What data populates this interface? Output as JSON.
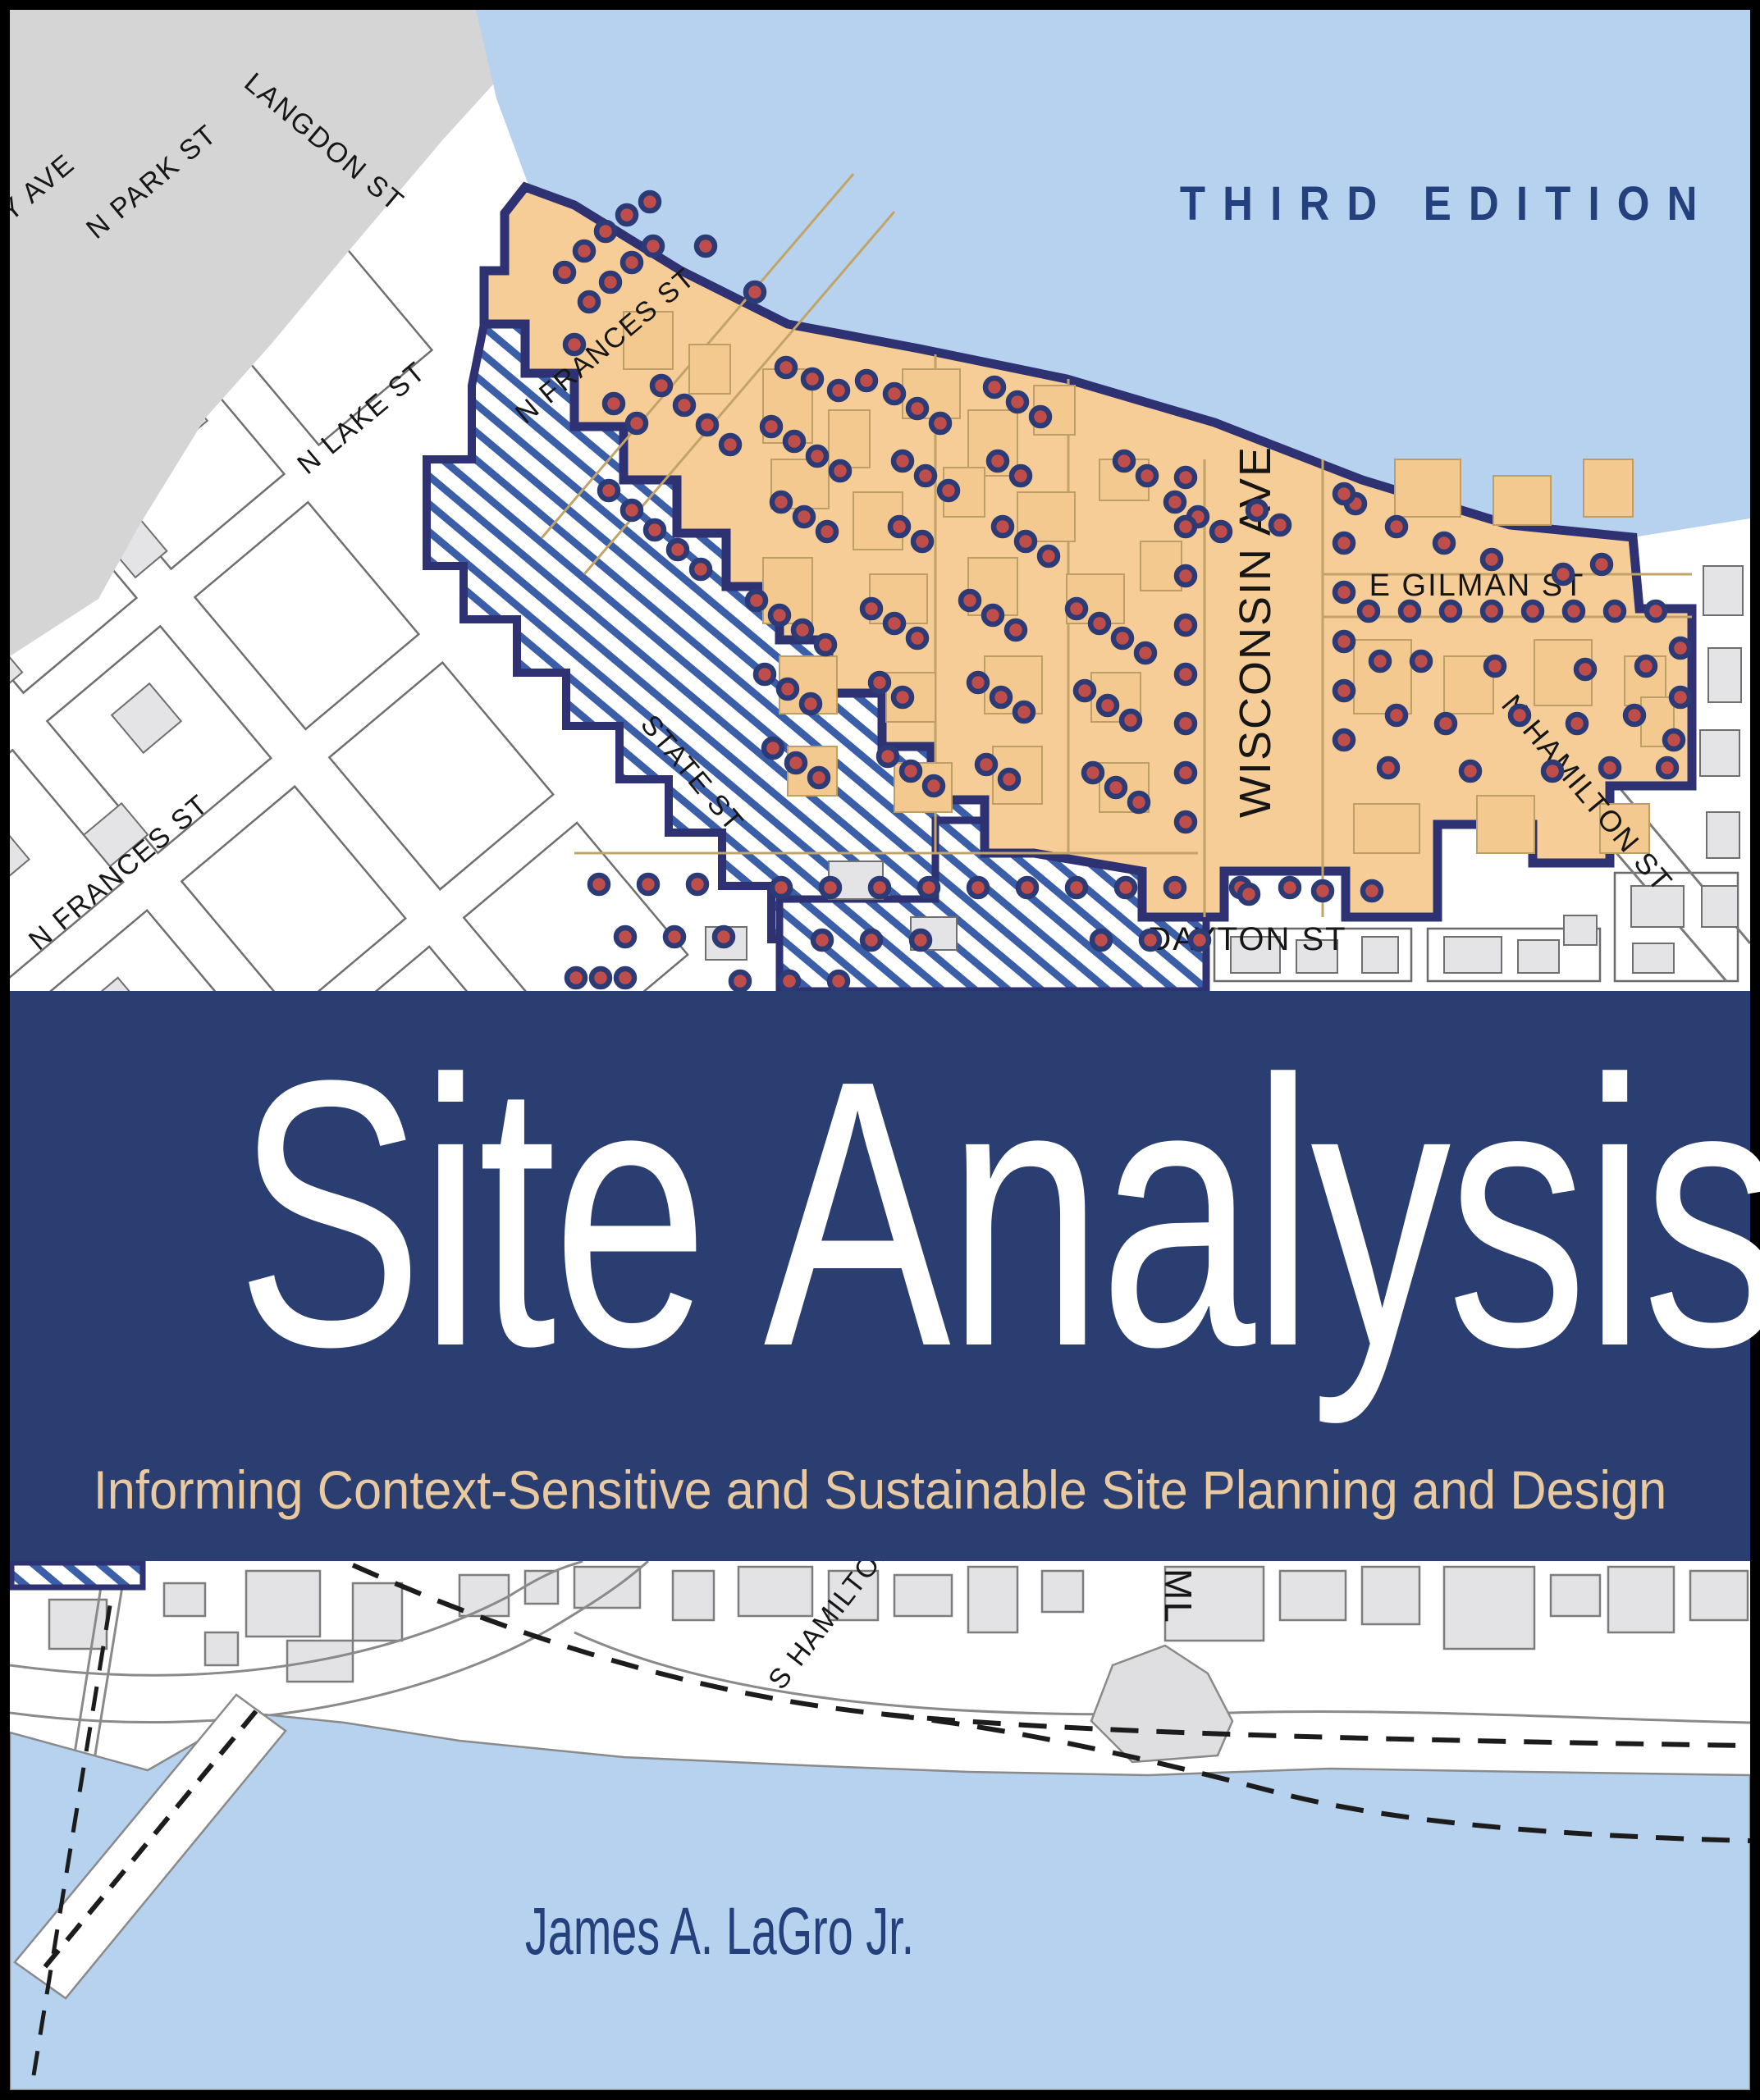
{
  "edition_label": "THIRD EDITION",
  "title": "Site Analysis",
  "subtitle": "Informing Context-Sensitive and Sustainable Site Planning and Design",
  "author": "James A. LaGro Jr.",
  "colors": {
    "frame": "#000000",
    "water": "#b7d2ee",
    "land": "#ffffff",
    "campus": "#d5d5d6",
    "building_fill": "#e4e4e6",
    "building_stroke": "#6f6f72",
    "district_fill": "#f6cd96",
    "district_building_fill": "#f3c98f",
    "district_building_stroke": "#bd9e66",
    "navy_border": "#2e3273",
    "hatch_blue": "#3b5ea9",
    "dot_red": "#bf4e4a",
    "dot_ring": "#2c3a75",
    "band_navy": "#2b3e71",
    "title_white": "#ffffff",
    "subtitle_tan": "#e9c9a0",
    "heading_navy": "#24407d",
    "street_label": "#161616"
  },
  "map_top": {
    "street_labels": {
      "university_ave": "ITY AVE",
      "n_park_st": "N PARK ST",
      "langdon_st": "LANGDON ST",
      "n_lake_st": "N LAKE ST",
      "n_frances_st_upper": "N FRANCES ST",
      "n_frances_st_lower": "N FRANCES ST",
      "wisconsin_ave": "WISCONSIN AVE",
      "e_gilman_st": "E GILMAN ST",
      "state_st": "STATE ST",
      "dayton_st": "DAYTON ST",
      "n_hamilton_st": "N HAMILTON ST"
    },
    "dot_radius": 11,
    "block_size": [
      180,
      210
    ],
    "blocks_diagonal": [
      [
        -700,
        -300
      ],
      [
        -700,
        -45
      ],
      [
        -700,
        210
      ],
      [
        -700,
        465
      ],
      [
        -700,
        720
      ],
      [
        -700,
        975
      ],
      [
        -700,
        1230
      ],
      [
        -465,
        -300
      ],
      [
        -465,
        -45
      ],
      [
        -465,
        210
      ],
      [
        -465,
        465
      ],
      [
        -465,
        720
      ],
      [
        -465,
        975
      ],
      [
        -465,
        1230
      ],
      [
        -230,
        -300
      ],
      [
        -230,
        -45
      ],
      [
        -230,
        210
      ],
      [
        -230,
        465
      ],
      [
        -230,
        720
      ],
      [
        -230,
        975
      ],
      [
        -230,
        1230
      ],
      [
        5,
        -300
      ],
      [
        5,
        -45
      ],
      [
        5,
        210
      ],
      [
        5,
        465
      ],
      [
        5,
        720
      ],
      [
        5,
        975
      ],
      [
        5,
        1230
      ],
      [
        240,
        -300
      ],
      [
        240,
        -45
      ],
      [
        240,
        210
      ],
      [
        240,
        465
      ],
      [
        240,
        720
      ],
      [
        240,
        975
      ],
      [
        475,
        -300
      ],
      [
        475,
        -45
      ],
      [
        475,
        210
      ]
    ],
    "buildings_diagonal": [
      [
        -680,
        -280,
        70,
        90
      ],
      [
        -600,
        -160,
        60,
        60
      ],
      [
        -445,
        -270,
        80,
        70
      ],
      [
        -380,
        -120,
        50,
        80
      ],
      [
        -210,
        -280,
        60,
        60
      ],
      [
        -160,
        -140,
        70,
        70
      ],
      [
        25,
        -270,
        70,
        80
      ],
      [
        90,
        -150,
        60,
        60
      ],
      [
        255,
        -270,
        60,
        70
      ],
      [
        320,
        -160,
        50,
        60
      ],
      [
        495,
        -270,
        70,
        70
      ],
      [
        540,
        -140,
        60,
        60
      ],
      [
        -690,
        -30,
        60,
        70
      ],
      [
        -560,
        60,
        70,
        60
      ],
      [
        -450,
        -20,
        60,
        60
      ],
      [
        -330,
        70,
        50,
        70
      ],
      [
        -200,
        -10,
        70,
        60
      ],
      [
        -90,
        80,
        60,
        60
      ],
      [
        30,
        -20,
        60,
        70
      ],
      [
        140,
        90,
        60,
        50
      ],
      [
        270,
        0,
        70,
        60
      ],
      [
        380,
        90,
        50,
        50
      ],
      [
        500,
        -10,
        60,
        60
      ],
      [
        -680,
        230,
        70,
        70
      ],
      [
        -540,
        320,
        60,
        60
      ],
      [
        -420,
        240,
        60,
        70
      ],
      [
        -290,
        330,
        50,
        60
      ],
      [
        -170,
        250,
        70,
        60
      ],
      [
        -40,
        340,
        60,
        60
      ],
      [
        80,
        250,
        60,
        60
      ],
      [
        200,
        340,
        50,
        60
      ],
      [
        330,
        250,
        60,
        60
      ],
      [
        -690,
        490,
        60,
        70
      ],
      [
        -550,
        580,
        70,
        60
      ],
      [
        -430,
        500,
        60,
        60
      ],
      [
        -300,
        590,
        50,
        60
      ],
      [
        -180,
        510,
        60,
        70
      ],
      [
        -50,
        600,
        60,
        50
      ],
      [
        70,
        510,
        60,
        60
      ],
      [
        -690,
        740,
        70,
        60
      ],
      [
        -560,
        830,
        60,
        60
      ],
      [
        -440,
        750,
        60,
        70
      ],
      [
        -310,
        840,
        50,
        50
      ],
      [
        -190,
        760,
        60,
        60
      ],
      [
        -690,
        1000,
        60,
        60
      ],
      [
        -560,
        1090,
        60,
        60
      ],
      [
        -440,
        1010,
        60,
        60
      ],
      [
        -690,
        1250,
        70,
        60
      ],
      [
        -560,
        1250,
        60,
        70
      ]
    ],
    "campus_buildings": [
      [
        -760,
        -340,
        90,
        110
      ],
      [
        -640,
        -350,
        70,
        80
      ],
      [
        -520,
        -340,
        100,
        90
      ],
      [
        -760,
        -180,
        80,
        90
      ],
      [
        -600,
        -200,
        110,
        140
      ],
      [
        -430,
        -190,
        70,
        90
      ],
      [
        -750,
        0,
        100,
        80
      ],
      [
        -600,
        -20,
        60,
        60
      ]
    ],
    "district_buildings": [
      [
        930,
        450,
        60,
        90
      ],
      [
        1010,
        500,
        50,
        70
      ],
      [
        1100,
        450,
        70,
        60
      ],
      [
        1180,
        500,
        60,
        80
      ],
      [
        1260,
        470,
        50,
        60
      ],
      [
        940,
        560,
        70,
        60
      ],
      [
        1040,
        600,
        60,
        70
      ],
      [
        1150,
        570,
        50,
        60
      ],
      [
        1240,
        600,
        70,
        60
      ],
      [
        1340,
        560,
        60,
        50
      ],
      [
        930,
        680,
        60,
        80
      ],
      [
        1060,
        700,
        70,
        60
      ],
      [
        1180,
        680,
        60,
        70
      ],
      [
        1300,
        700,
        70,
        60
      ],
      [
        1390,
        660,
        50,
        60
      ],
      [
        950,
        800,
        70,
        70
      ],
      [
        1080,
        820,
        60,
        60
      ],
      [
        1200,
        800,
        70,
        70
      ],
      [
        1330,
        820,
        60,
        60
      ],
      [
        960,
        910,
        60,
        60
      ],
      [
        1090,
        930,
        70,
        60
      ],
      [
        1210,
        910,
        60,
        70
      ],
      [
        1340,
        930,
        60,
        60
      ],
      [
        1650,
        780,
        70,
        90
      ],
      [
        1760,
        800,
        60,
        70
      ],
      [
        1870,
        780,
        70,
        80
      ],
      [
        1980,
        800,
        50,
        60
      ],
      [
        1650,
        980,
        80,
        60
      ],
      [
        1800,
        970,
        70,
        70
      ],
      [
        1950,
        980,
        60,
        60
      ],
      [
        1700,
        560,
        80,
        70
      ],
      [
        1820,
        580,
        70,
        60
      ],
      [
        1930,
        560,
        60,
        70
      ],
      [
        2000,
        850,
        40,
        60
      ],
      [
        760,
        380,
        60,
        70
      ],
      [
        840,
        420,
        50,
        60
      ]
    ],
    "gray_buildings": [
      [
        1500,
        1142,
        60,
        44
      ],
      [
        1580,
        1146,
        50,
        40
      ],
      [
        1660,
        1142,
        44,
        44
      ],
      [
        1760,
        1142,
        70,
        44
      ],
      [
        1850,
        1146,
        50,
        40
      ],
      [
        1988,
        1080,
        64,
        50
      ],
      [
        1990,
        1150,
        50,
        36
      ],
      [
        2076,
        690,
        48,
        60
      ],
      [
        2082,
        790,
        40,
        66
      ],
      [
        2072,
        890,
        48,
        56
      ],
      [
        2080,
        990,
        40,
        56
      ],
      [
        2074,
        1080,
        44,
        50
      ],
      [
        1906,
        1116,
        40,
        36
      ],
      [
        1010,
        1050,
        66,
        46
      ],
      [
        1110,
        1118,
        56,
        40
      ],
      [
        860,
        1130,
        50,
        40
      ]
    ],
    "dots": [
      [
        688,
        332
      ],
      [
        712,
        306
      ],
      [
        738,
        282
      ],
      [
        764,
        262
      ],
      [
        792,
        246
      ],
      [
        718,
        368
      ],
      [
        744,
        344
      ],
      [
        770,
        320
      ],
      [
        796,
        300
      ],
      [
        860,
        300
      ],
      [
        920,
        356
      ],
      [
        700,
        420
      ],
      [
        748,
        492
      ],
      [
        776,
        516
      ],
      [
        806,
        470
      ],
      [
        834,
        494
      ],
      [
        862,
        518
      ],
      [
        890,
        542
      ],
      [
        742,
        598
      ],
      [
        770,
        622
      ],
      [
        798,
        646
      ],
      [
        826,
        670
      ],
      [
        854,
        694
      ],
      [
        958,
        448
      ],
      [
        990,
        462
      ],
      [
        1022,
        476
      ],
      [
        1056,
        464
      ],
      [
        940,
        520
      ],
      [
        968,
        538
      ],
      [
        996,
        556
      ],
      [
        1024,
        574
      ],
      [
        952,
        612
      ],
      [
        980,
        630
      ],
      [
        1008,
        648
      ],
      [
        1090,
        480
      ],
      [
        1118,
        498
      ],
      [
        1146,
        516
      ],
      [
        1100,
        562
      ],
      [
        1128,
        580
      ],
      [
        1156,
        598
      ],
      [
        1096,
        642
      ],
      [
        1124,
        660
      ],
      [
        1212,
        472
      ],
      [
        1240,
        490
      ],
      [
        1268,
        508
      ],
      [
        1216,
        562
      ],
      [
        1244,
        580
      ],
      [
        1222,
        642
      ],
      [
        1250,
        660
      ],
      [
        1278,
        678
      ],
      [
        1370,
        562
      ],
      [
        1398,
        580
      ],
      [
        1432,
        612
      ],
      [
        1460,
        630
      ],
      [
        1488,
        648
      ],
      [
        1532,
        622
      ],
      [
        1560,
        640
      ],
      [
        1652,
        614
      ],
      [
        1702,
        642
      ],
      [
        1760,
        662
      ],
      [
        1818,
        682
      ],
      [
        1905,
        700
      ],
      [
        1952,
        688
      ],
      [
        1445,
        582
      ],
      [
        1445,
        642
      ],
      [
        1445,
        702
      ],
      [
        1445,
        762
      ],
      [
        1445,
        822
      ],
      [
        1445,
        882
      ],
      [
        1445,
        942
      ],
      [
        1445,
        1002
      ],
      [
        1638,
        602
      ],
      [
        1638,
        662
      ],
      [
        1638,
        722
      ],
      [
        1638,
        782
      ],
      [
        1638,
        842
      ],
      [
        1638,
        902
      ],
      [
        1668,
        745
      ],
      [
        1718,
        745
      ],
      [
        1768,
        745
      ],
      [
        1818,
        745
      ],
      [
        1868,
        745
      ],
      [
        1918,
        745
      ],
      [
        1968,
        745
      ],
      [
        2018,
        745
      ],
      [
        1682,
        806
      ],
      [
        1732,
        806
      ],
      [
        1822,
        812
      ],
      [
        1932,
        816
      ],
      [
        2006,
        812
      ],
      [
        1702,
        872
      ],
      [
        1762,
        882
      ],
      [
        1852,
        872
      ],
      [
        1922,
        882
      ],
      [
        1992,
        872
      ],
      [
        2040,
        902
      ],
      [
        1692,
        936
      ],
      [
        1792,
        940
      ],
      [
        1892,
        940
      ],
      [
        1962,
        936
      ],
      [
        2032,
        936
      ],
      [
        922,
        732
      ],
      [
        950,
        750
      ],
      [
        978,
        768
      ],
      [
        1006,
        786
      ],
      [
        932,
        822
      ],
      [
        960,
        840
      ],
      [
        988,
        858
      ],
      [
        942,
        912
      ],
      [
        970,
        930
      ],
      [
        998,
        948
      ],
      [
        1062,
        742
      ],
      [
        1090,
        760
      ],
      [
        1118,
        778
      ],
      [
        1072,
        832
      ],
      [
        1100,
        850
      ],
      [
        1082,
        922
      ],
      [
        1110,
        940
      ],
      [
        1138,
        958
      ],
      [
        1182,
        732
      ],
      [
        1210,
        750
      ],
      [
        1238,
        768
      ],
      [
        1192,
        832
      ],
      [
        1220,
        850
      ],
      [
        1248,
        868
      ],
      [
        1202,
        932
      ],
      [
        1230,
        950
      ],
      [
        1312,
        742
      ],
      [
        1340,
        760
      ],
      [
        1368,
        778
      ],
      [
        1396,
        796
      ],
      [
        1322,
        842
      ],
      [
        1350,
        860
      ],
      [
        1378,
        878
      ],
      [
        1332,
        942
      ],
      [
        1360,
        960
      ],
      [
        1388,
        978
      ],
      [
        730,
        1078
      ],
      [
        790,
        1078
      ],
      [
        850,
        1078
      ],
      [
        952,
        1082
      ],
      [
        1012,
        1082
      ],
      [
        1072,
        1082
      ],
      [
        1132,
        1082
      ],
      [
        1192,
        1082
      ],
      [
        1252,
        1082
      ],
      [
        762,
        1142
      ],
      [
        822,
        1142
      ],
      [
        882,
        1142
      ],
      [
        1002,
        1146
      ],
      [
        1062,
        1146
      ],
      [
        1122,
        1146
      ],
      [
        702,
        1192
      ],
      [
        732,
        1192
      ],
      [
        762,
        1192
      ],
      [
        902,
        1196
      ],
      [
        962,
        1196
      ],
      [
        1022,
        1196
      ],
      [
        1312,
        1082
      ],
      [
        1372,
        1082
      ],
      [
        1432,
        1082
      ],
      [
        1512,
        1082
      ],
      [
        1572,
        1082
      ],
      [
        1612,
        1086
      ],
      [
        1672,
        1086
      ],
      [
        1342,
        1146
      ],
      [
        1402,
        1146
      ],
      [
        1462,
        1146
      ],
      [
        1522,
        1090
      ],
      [
        2048,
        790
      ],
      [
        2048,
        850
      ]
    ]
  },
  "map_bottom": {
    "street_labels": {
      "s_hamilton_st": "S HAMILTON ST",
      "ml": "ML"
    },
    "buildings": [
      [
        60,
        1950,
        70,
        60
      ],
      [
        200,
        1930,
        50,
        40
      ],
      [
        300,
        1915,
        90,
        80
      ],
      [
        430,
        1930,
        60,
        70
      ],
      [
        560,
        1920,
        60,
        50
      ],
      [
        640,
        1915,
        40,
        40
      ],
      [
        700,
        1910,
        80,
        50
      ],
      [
        820,
        1915,
        50,
        60
      ],
      [
        900,
        1910,
        90,
        60
      ],
      [
        1010,
        1915,
        60,
        60
      ],
      [
        1090,
        1920,
        70,
        50
      ],
      [
        1180,
        1910,
        60,
        80
      ],
      [
        1270,
        1915,
        50,
        50
      ],
      [
        1420,
        1910,
        120,
        90
      ],
      [
        1560,
        1915,
        80,
        60
      ],
      [
        1660,
        1910,
        70,
        70
      ],
      [
        1760,
        1910,
        110,
        100
      ],
      [
        1890,
        1920,
        60,
        50
      ],
      [
        1960,
        1910,
        80,
        80
      ],
      [
        2060,
        1915,
        70,
        60
      ],
      [
        350,
        2000,
        80,
        50
      ],
      [
        250,
        1990,
        40,
        40
      ]
    ]
  }
}
